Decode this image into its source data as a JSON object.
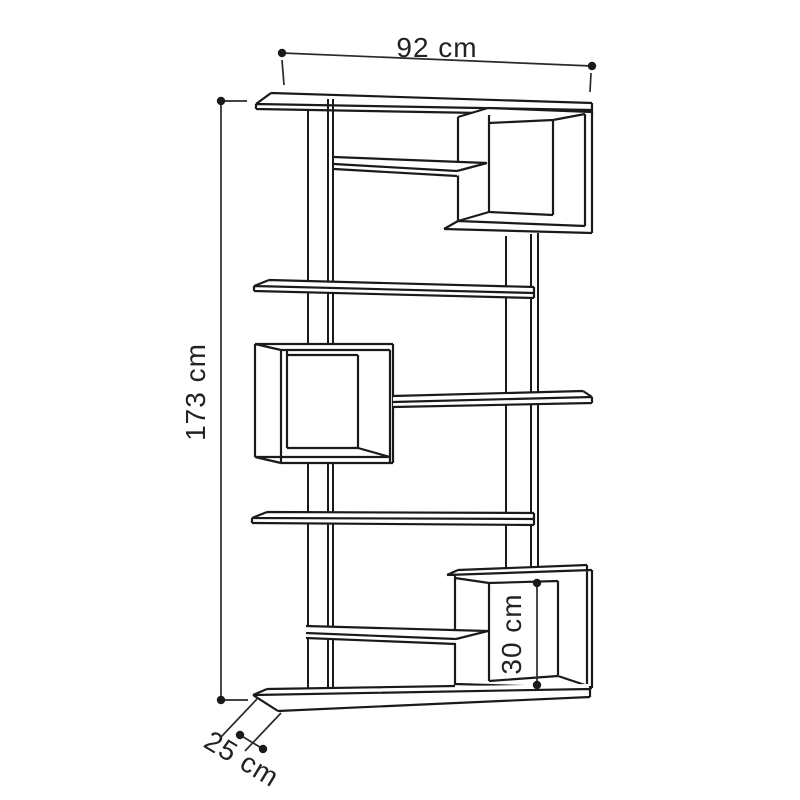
{
  "dimensions": {
    "width": "92 cm",
    "height": "173 cm",
    "depth": "25 cm",
    "cube_height": "30 cm"
  },
  "colors": {
    "line": "#1a1a1a",
    "label_text": "#222222",
    "background": "#ffffff"
  }
}
